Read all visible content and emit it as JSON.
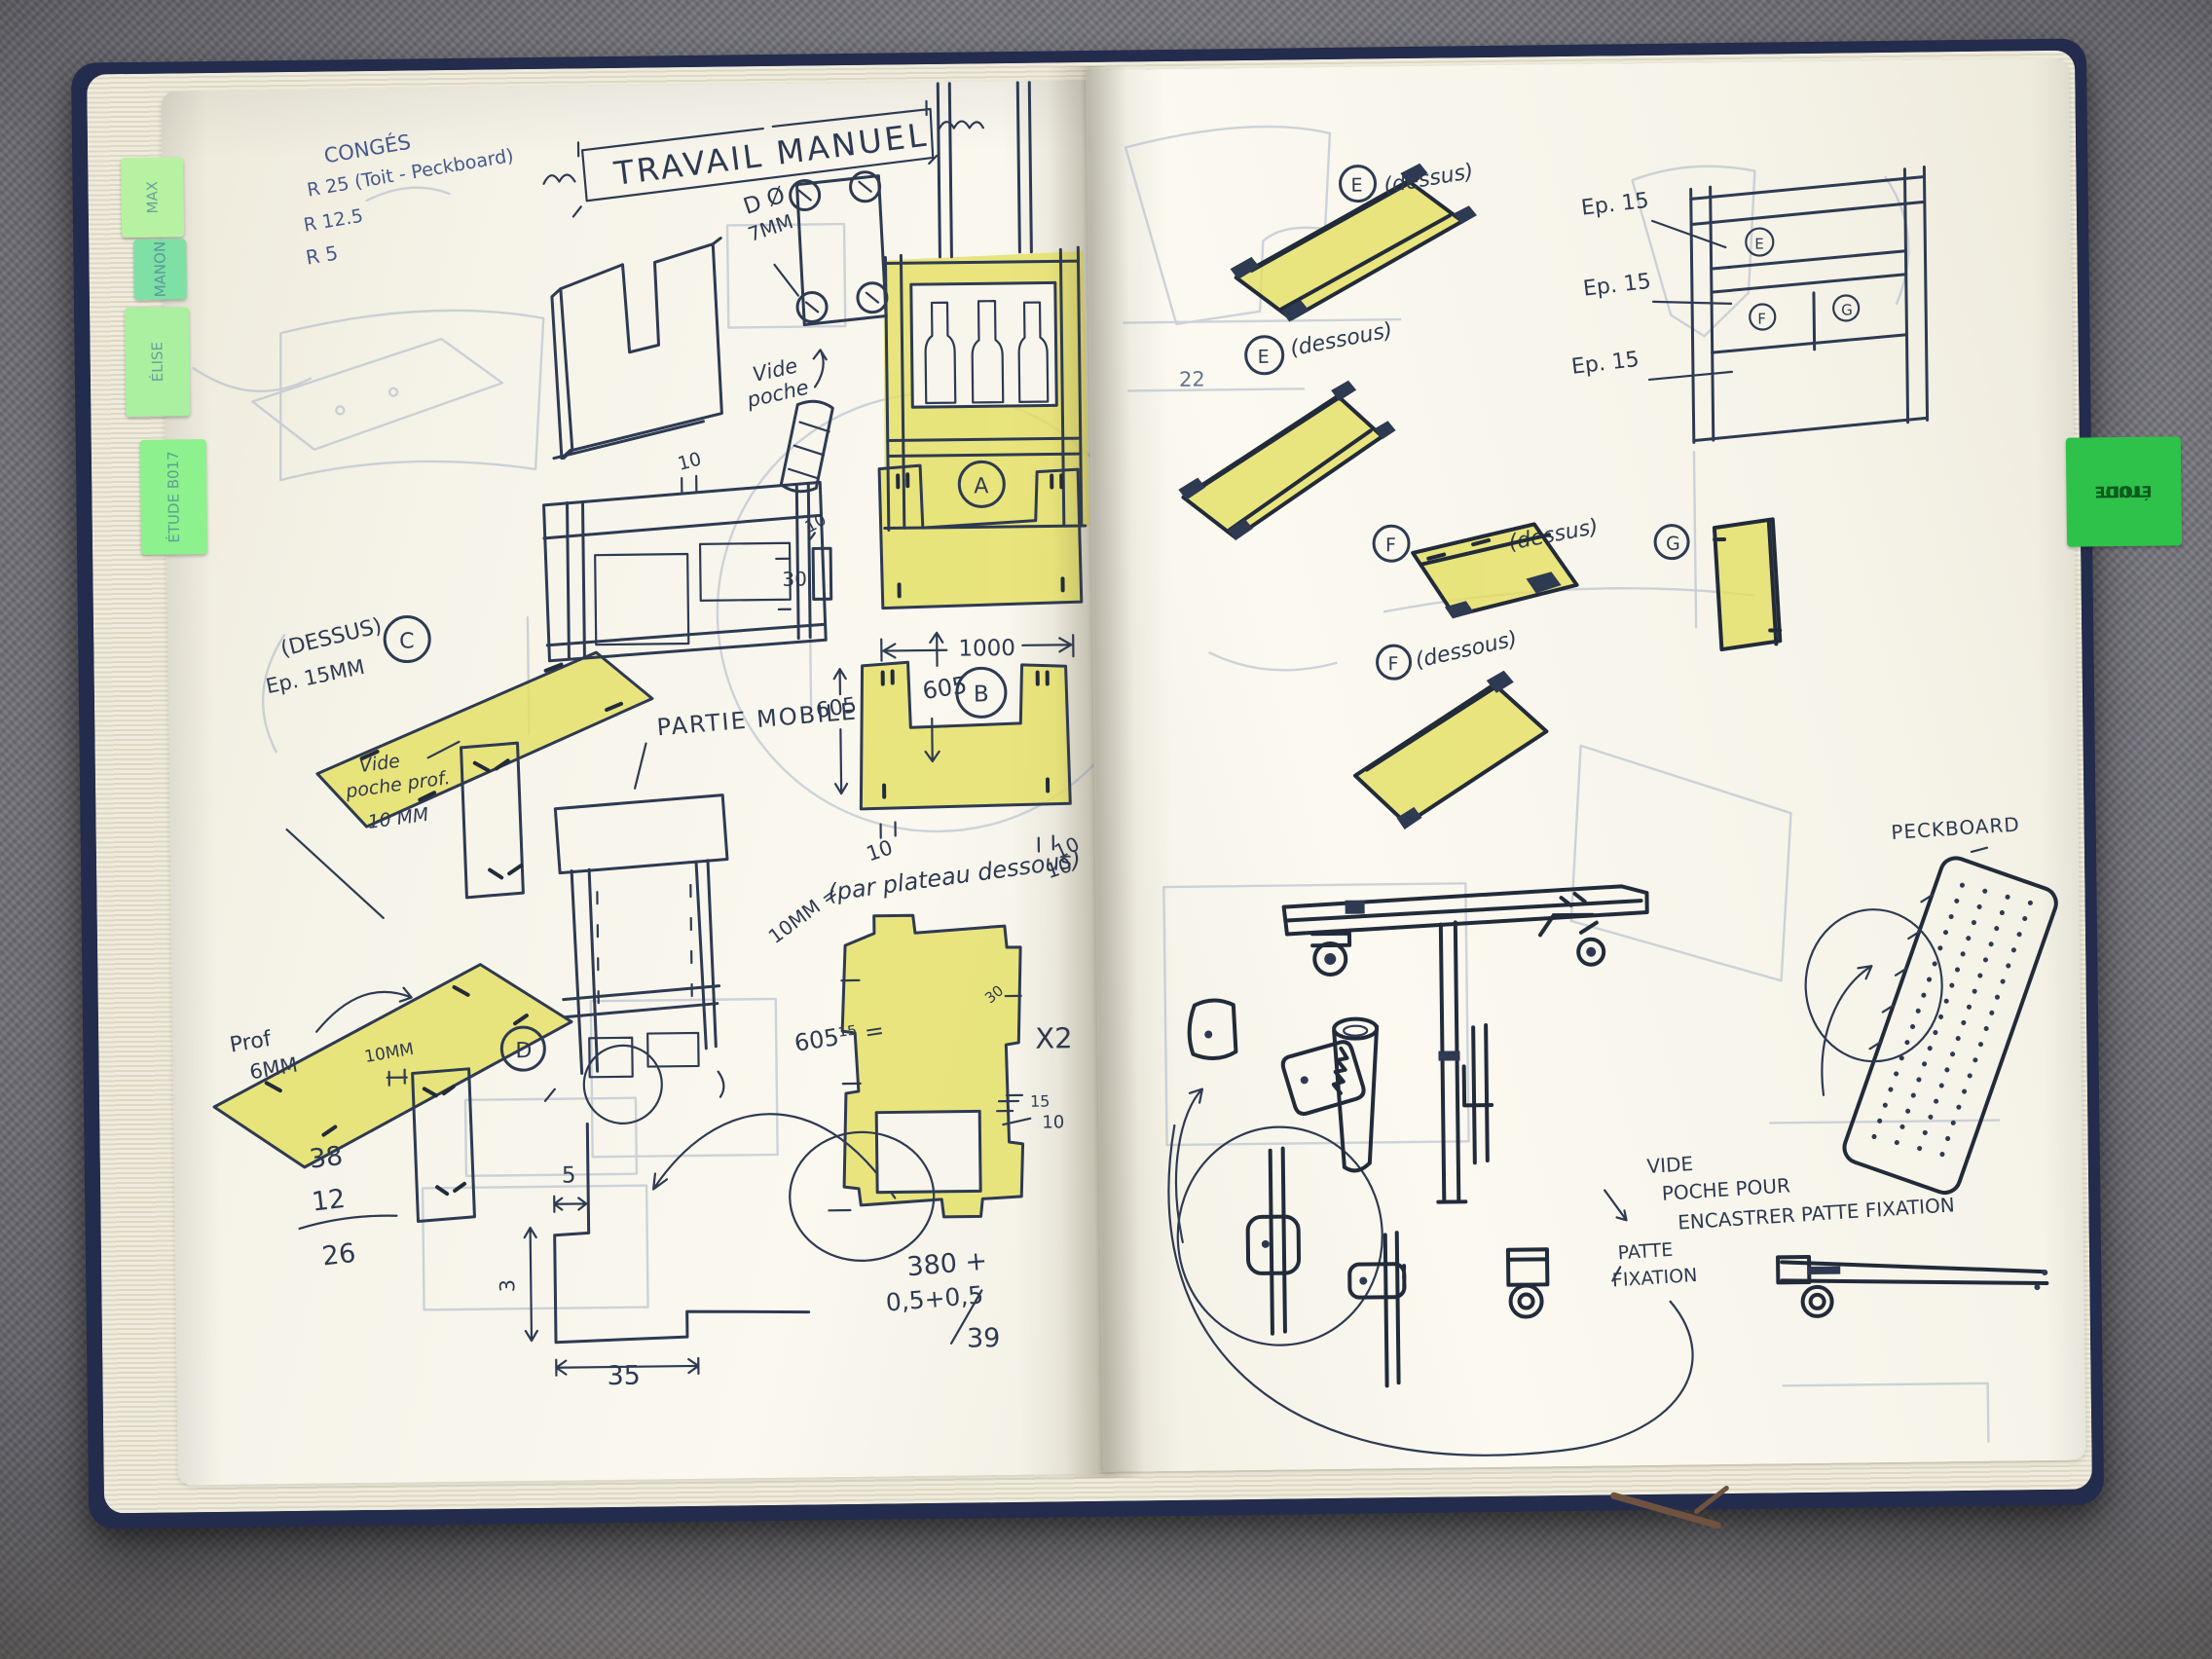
{
  "scene": {
    "carpet_color": "#83838b",
    "page_color": "#f6f4e9",
    "ink_color": "#2e3a52",
    "pencil_color": "#a2aec4",
    "highlighter_color": "#e4df5d",
    "cover_color": "#232c4c"
  },
  "tabs": {
    "left": [
      {
        "label": "MAX"
      },
      {
        "label": "MANON"
      },
      {
        "label": "ÉLISE"
      },
      {
        "label": "ÉTUDE B017"
      }
    ],
    "right": {
      "line1": "TOIT",
      "line2": "ÉTUDE"
    }
  },
  "left_page": {
    "notes_top": {
      "line1": "CONGÉS",
      "line2": "R 25 (Toit - Peckboard)",
      "line3": "R 12.5",
      "line4": "R 5"
    },
    "title": "TRAVAIL MANUEL",
    "drill": {
      "line1": "D Ø",
      "line2": "7MM"
    },
    "vide_poche": {
      "line1": "Vide",
      "line2": "poche"
    },
    "shelf_dim_10": "10",
    "partie_mobile": "PARTIE MOBILE",
    "dim_605_side": "605",
    "c_part": {
      "letter": "C",
      "dessus": "(DESSUS)",
      "ep": "Ep. 15MM"
    },
    "vide_poche_prof": {
      "line1": "Vide",
      "line2": "poche prof.",
      "line3": "10 MM"
    },
    "d_part": {
      "letter": "D",
      "prof1": "Prof",
      "prof2": "6MM",
      "dim": "10MM"
    },
    "subtraction": {
      "a": "38",
      "b": "12",
      "result": "26"
    },
    "step_dims": {
      "top": "5",
      "side": "3",
      "bottom": "35"
    },
    "a_part": {
      "letter": "A"
    },
    "spacer": {
      "w": "10",
      "h": "30"
    },
    "b_part": {
      "letter": "B",
      "dim_width": "1000",
      "dim_height": "605",
      "tick_left": "10",
      "tick_right": "10"
    },
    "plateau_note": "(par plateau dessous)",
    "plateau_dim": "10MM =",
    "stray_10": "10",
    "xray": {
      "height": "605¹⁵ =",
      "notch": "30",
      "qty": "X2",
      "t15": "15",
      "t10": "10"
    },
    "calc": {
      "line1": "380 +",
      "line2": "0,5+0,5",
      "result": "39"
    }
  },
  "right_page": {
    "e_top": {
      "letter": "E",
      "label": "(dessus)"
    },
    "e_bottom": {
      "letter": "E",
      "label": "(dessous)",
      "note": "22"
    },
    "thickness": {
      "t1": "Ep. 15",
      "t2": "Ep. 15",
      "t3": "Ep. 15"
    },
    "frame_letters": {
      "top": "E",
      "left": "F",
      "right": "G"
    },
    "f_top": {
      "letter": "F",
      "label": "(dessus)"
    },
    "g_part": {
      "letter": "G"
    },
    "f_bottom": {
      "letter": "F",
      "label": "(dessous)"
    },
    "peckboard": "PECKBOARD",
    "pocket_note": {
      "line1": "VIDE",
      "line2": "POCHE POUR",
      "line3": "ENCASTRER PATTE FIXATION"
    },
    "bracket_label": {
      "line1": "PATTE",
      "line2": "FIXATION"
    }
  }
}
